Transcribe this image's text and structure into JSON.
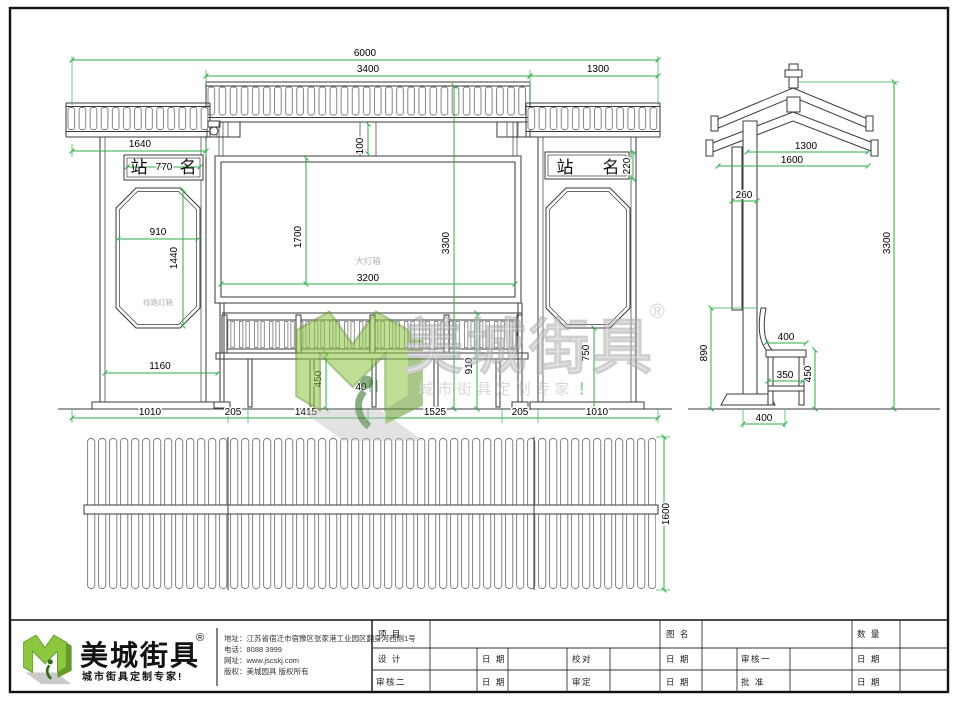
{
  "colors": {
    "dimension": "#2fae4a",
    "line": "#3a3a3a",
    "logo_green": "#8dc63f",
    "logo_green_dark": "#649a2e",
    "watermark_gray": "#c6c6c6"
  },
  "front_view": {
    "signs": {
      "zhan": "站",
      "ming": "名"
    },
    "labels": {
      "main_lightbox": "大灯箱",
      "route_lightbox": "线路灯箱"
    },
    "dims": {
      "total_width": "6000",
      "roof_center_width": "3400",
      "roof_side_width": "1300",
      "left_section_width": "1640",
      "sign_width": "770",
      "roof_gap": "100",
      "sign_height": "220",
      "octagon_width": "910",
      "octagon_height": "1440",
      "lightbox_height": "1700",
      "lightbox_width": "3200",
      "total_height": "3300",
      "left_bottom_width": "1160",
      "bench_height": "450",
      "leg_width": "40",
      "backrest_height": "910",
      "pillar_base_height": "750",
      "base_segments": [
        "1010",
        "205",
        "1415",
        "1525",
        "205",
        "1010"
      ]
    }
  },
  "side_view": {
    "dims": {
      "roof_inner_width": "1300",
      "roof_outer_width": "1600",
      "pole_width": "260",
      "total_height": "3300",
      "backrest_height": "890",
      "seat_depth": "400",
      "seat_height": "450",
      "seat_width": "350",
      "base_width": "400"
    }
  },
  "plan_view": {
    "dims": {
      "depth": "1600"
    }
  },
  "watermark": {
    "brand": "美城街具",
    "registered": "®",
    "slogan": "城市街具定制专家",
    "slogan_mark": "！"
  },
  "footer": {
    "brand": "美城街具",
    "registered": "®",
    "slogan": "城市街具定制专家!",
    "contact": {
      "address": "地址：江苏省宿迁市宿豫区张家港工业园区翻身河西侧1号",
      "phone": "电话：8088 3999",
      "website": "网址：www.jscskj.com",
      "copyright": "版权：美城园具 版权所有"
    },
    "titleblock": {
      "row1": [
        "项 目",
        "图 名",
        "数 量"
      ],
      "row2": [
        "设 计",
        "日 期",
        "校对",
        "日 期",
        "审核一",
        "日 期"
      ],
      "row3": [
        "审核二",
        "日 期",
        "审定",
        "日 期",
        "批 准",
        "日 期"
      ]
    }
  }
}
